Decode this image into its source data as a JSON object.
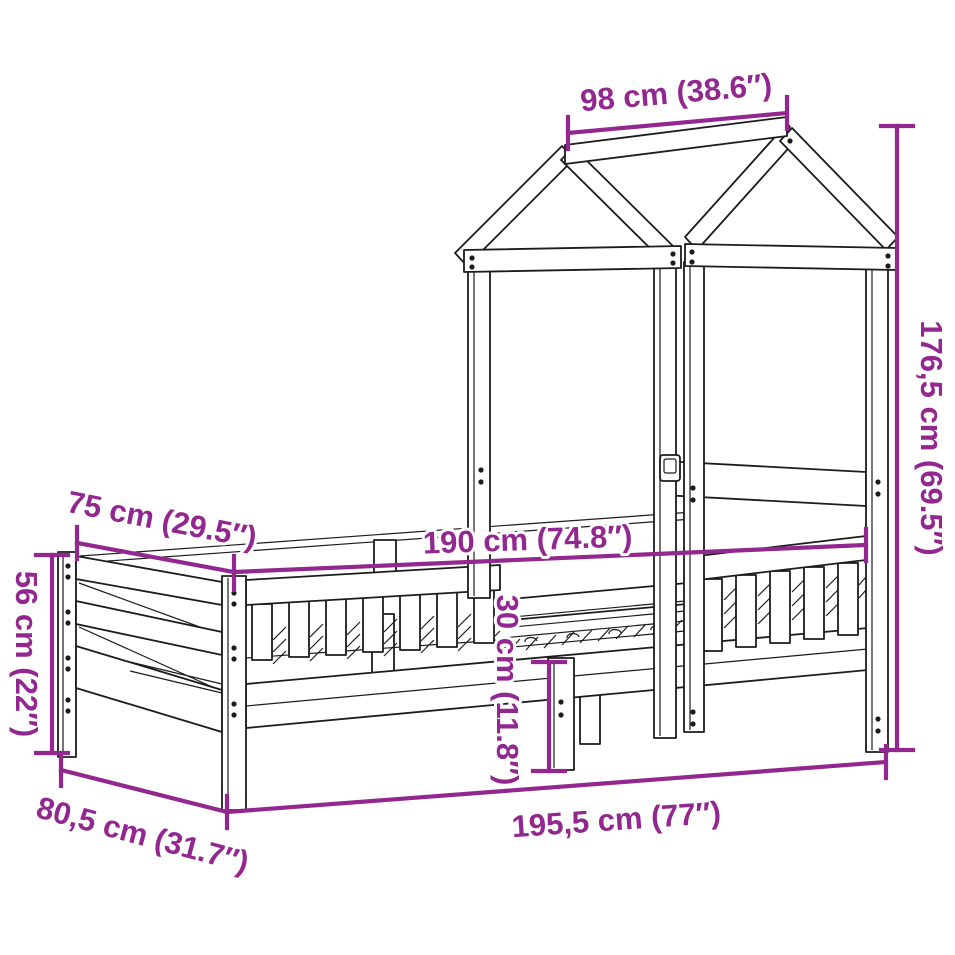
{
  "colors": {
    "dimension": "#92278F",
    "line": "#1c1c1c",
    "background": "#ffffff"
  },
  "diagram": {
    "type": "furniture-dimension-diagram",
    "subject": "house-frame bed with roof canopy"
  },
  "dimensions": [
    {
      "id": "roof-top-width",
      "label": "98 cm (38.6″)"
    },
    {
      "id": "overall-height",
      "label": "176,5 cm (69.5″)"
    },
    {
      "id": "bed-width",
      "label": "75 cm (29.5″)"
    },
    {
      "id": "bed-length",
      "label": "190 cm (74.8″)"
    },
    {
      "id": "footboard-height",
      "label": "56 cm (22″)"
    },
    {
      "id": "clearance-height",
      "label": "30 cm (11.8″)"
    },
    {
      "id": "overall-width",
      "label": "80,5 cm (31.7″)"
    },
    {
      "id": "overall-length",
      "label": "195,5 cm (77″)"
    }
  ]
}
